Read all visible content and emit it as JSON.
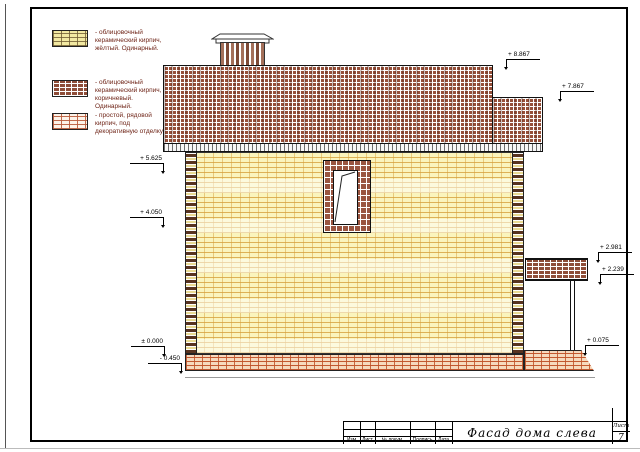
{
  "drawing": {
    "title": "Фасад дома слева",
    "sheet_label": "Лист",
    "sheet_number": "7",
    "stamp_columns": [
      "Изм",
      "Лист",
      "№ докум.",
      "Подпись",
      "Дата"
    ]
  },
  "legend": {
    "items": [
      {
        "swatch": "yellow-facing-brick",
        "text": "- облицовочный керамический кирпич, жёлтый. Одинарный."
      },
      {
        "swatch": "brown-facing-brick",
        "text": "- облицовочный керамический кирпич, коричневый. Одинарный."
      },
      {
        "swatch": "plain-brick",
        "text": "- простой, рядовой кирпич, под декоративную отделку"
      }
    ]
  },
  "markers": {
    "left": [
      "+ 5.625",
      "+ 4.050",
      "± 0.000",
      "- 0.450"
    ],
    "right": [
      "+ 8.867",
      "+ 7.867",
      "+ 2.981",
      "+ 2.239",
      "+ 0.075"
    ]
  },
  "colors": {
    "yellow_brick": "#FAF4BD",
    "brown_brick": "#96503A",
    "plain_brick_joint": "#C05228",
    "legend_text": "#6E2417"
  }
}
